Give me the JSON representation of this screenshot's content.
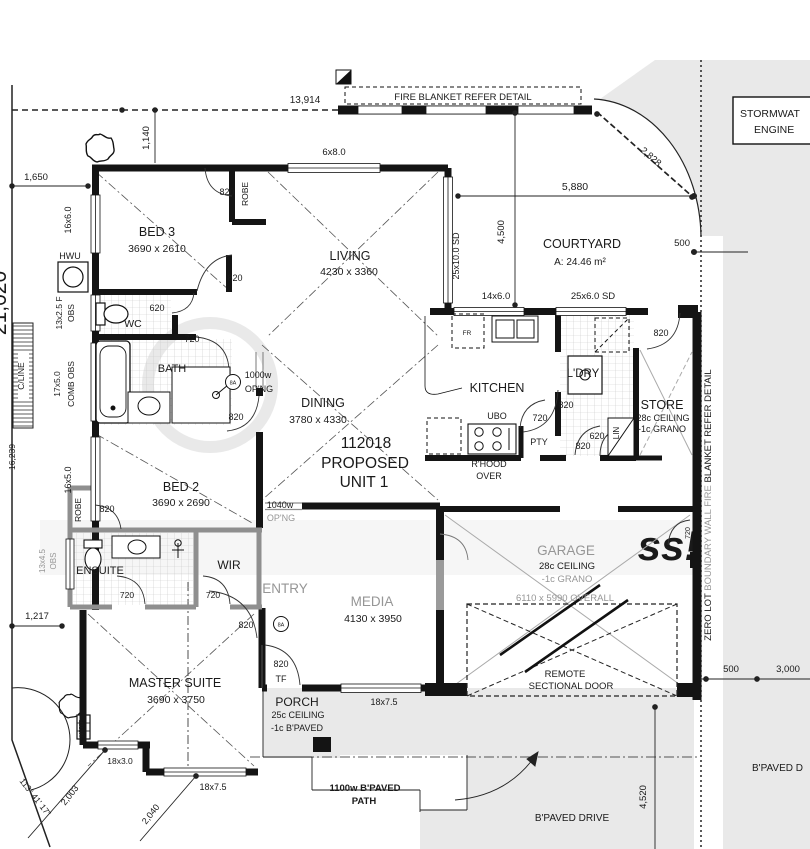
{
  "plan": {
    "unit_title": {
      "line1": "112018",
      "line2": "PROPOSED",
      "line3": "UNIT 1"
    },
    "rooms": {
      "bed3": {
        "name": "BED 3",
        "dims": "3690 x 2610"
      },
      "living": {
        "name": "LIVING",
        "dims": "4230 x 3360"
      },
      "dining": {
        "name": "DINING",
        "dims": "3780 x 4330"
      },
      "bed2": {
        "name": "BED 2",
        "dims": "3690 x 2690"
      },
      "master": {
        "name": "MASTER SUITE",
        "dims": "3690 x 3750"
      },
      "media": {
        "name": "MEDIA",
        "dims": "4130 x 3950"
      },
      "kitchen": {
        "name": "KITCHEN"
      },
      "wc": {
        "name": "WC"
      },
      "bath": {
        "name": "BATH"
      },
      "ensuite": {
        "name": "ENSUITE"
      },
      "wir": {
        "name": "WIR"
      },
      "entry": {
        "name": "ENTRY"
      },
      "ldry": {
        "name": "L'DRY"
      },
      "lin": {
        "name": "LIN"
      },
      "pty": {
        "name": "PTY"
      },
      "store": {
        "name": "STORE",
        "ceiling": "28c CEILING",
        "floor": "-1c GRANO"
      },
      "garage": {
        "name": "GARAGE",
        "ceiling": "28c CEILING",
        "floor": "-1c GRANO",
        "overall": "6110 x 5990 OVERALL",
        "door_line1": "REMOTE",
        "door_line2": "SECTIONAL DOOR"
      },
      "porch": {
        "name": "PORCH",
        "ceiling": "25c CEILING",
        "floor": "-1c B'PAVED"
      },
      "courtyard": {
        "name": "COURTYARD",
        "area": "A: 24.46 m²"
      },
      "robe_bed3": "ROBE",
      "robe_bed2": "ROBE",
      "ubo": "UBO",
      "fridge": "FR",
      "hwu": "HWU",
      "rhood_line1": "R'HOOD",
      "rhood_line2": "OVER"
    },
    "doors": {
      "bed3_a": "820",
      "bed3_b": "820",
      "wc": "620",
      "bath": "720",
      "bed2": "820",
      "robe_bed2": "820",
      "ensuite": "720",
      "wir": "720",
      "entry": "820",
      "front": "820",
      "front_tf": "TF",
      "kitchen": "820",
      "pantry": "720",
      "ldry_a": "620",
      "ldry_b": "820",
      "store": "820",
      "garage_rear": "720",
      "opening_1000_w": "1000w",
      "opening_1000_l": "OP'NG",
      "opening_1040_w": "1040w",
      "opening_1040_l": "OP'NG",
      "sa_1": "8A",
      "sa_2": "8A"
    },
    "windows": {
      "w6x8": "6x8.0",
      "w16x6": "16x6.0",
      "w13x25_a": "13x2.5 F",
      "w13x25_b": "OBS",
      "w17x5_a": "17x5.0",
      "w17x5_b": "COMB OBS",
      "w16x5": "16x5.0",
      "w13x45_a": "13x4.5",
      "w13x45_b": "OBS",
      "w18x3": "18x3.0",
      "w18x75_a": "18x7.5",
      "w18x75_b": "18x7.5",
      "w14x6": "14x6.0",
      "w25x6": "25x6.0 SD",
      "w25x10": "25x10.0 SD"
    },
    "dims": {
      "d13914": "13,914",
      "d1140": "1,140",
      "d1650": "1,650",
      "d2828": "2,828",
      "d5880": "5,880",
      "d4500": "4,500",
      "d500_top": "500",
      "d500_right": "500",
      "d3000": "3,000",
      "d4520": "4,520",
      "d21020": "21,020",
      "d16239": "16,239",
      "d1217": "1,217",
      "d2003": "2,003",
      "d2040": "2,040",
      "angle": "113° 41' 17\""
    },
    "site": {
      "cline": "C/LINE",
      "meter": "METER",
      "bpaved_d": "B'PAVED D",
      "bpaved_drive": "B'PAVED DRIVE",
      "path_line1": "1100w B'PAVED",
      "path_line2": "PATH"
    },
    "notes": {
      "fire_blanket": "FIRE BLANKET REFER DETAIL",
      "stormwater_line1": "STORMWAT",
      "stormwater_line2": "ENGINE",
      "zero_lot_1": "ZERO LOT ",
      "zero_lot_2": "BOUNDARY WALL FIRE ",
      "zero_lot_3": "BLANKET REFER DETAIL"
    },
    "watermark": "ss!"
  }
}
